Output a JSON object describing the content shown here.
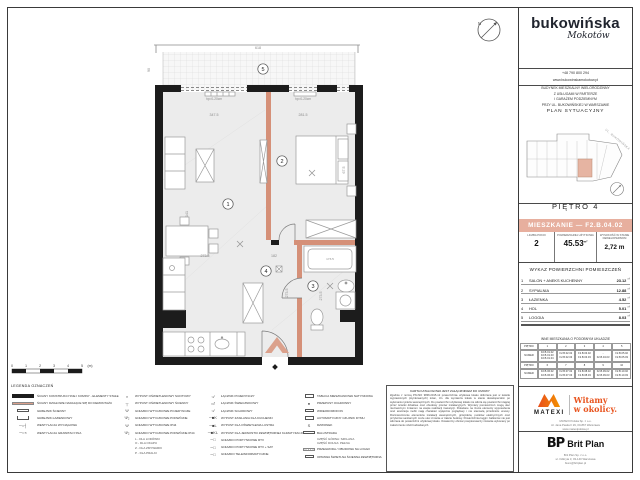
{
  "accent_salmon": "#e7af9e",
  "accent_orange": "#e8531d",
  "plan": {
    "room_numbers": [
      "1",
      "2",
      "3",
      "4",
      "5"
    ],
    "window_label_left": "hp=0-20cm",
    "window_label_right": "hp=0-20cm",
    "compass": "N",
    "dims": {
      "balcony": "618",
      "loggia_depth": "90",
      "salon_window": "347.5",
      "bedroom_window": "281.5",
      "salon_left": "141",
      "kitchen": "273.5",
      "hol": "182",
      "bathtub": "173.5",
      "bed": "67.5",
      "hol_v": "273.5",
      "bath_v": "273.5"
    },
    "scale_ticks": [
      "0",
      "1",
      "2",
      "3",
      "4",
      "5"
    ],
    "scale_unit": "(m)"
  },
  "sidebar": {
    "brand": {
      "name": "bukowińska",
      "script": "Mokotów"
    },
    "phone": "+48 790 800 294",
    "website": "www.bukowinskamokotow.pl",
    "description_lines": [
      "BUDYNEK MIESZKALNY WIELORODZINNY",
      "Z USŁUGAMI W PARTERZE",
      "I GARAŻEM PODZIEMNYM",
      "PRZY UL. BUKOWIŃSKIEJ W WARSZAWIE"
    ],
    "site_plan_title": "PLAN SYTUACYJNY",
    "street_label": "UL. BUKOWIŃSKA",
    "floor_label": "PIĘTRO 4",
    "apartment_label": "MIESZKANIE — F2.B.04.02",
    "stats": {
      "rooms": {
        "label": "LICZBA POKOI",
        "value": "2"
      },
      "area": {
        "label": "POWIERZCHNIA UŻYTKOWA",
        "value": "45.53",
        "unit": "m²"
      },
      "height": {
        "label": "WYSOKOŚĆ W STANIE DEWELOPERSKIM",
        "value": "2,72 m"
      }
    },
    "rooms_table": {
      "title": "WYKAZ POWIERZCHNI POMIESZCZEŃ",
      "unit": "m²",
      "rows": [
        {
          "no": "1",
          "name": "SALON + ANEKS KUCHENNY",
          "area": "23.12"
        },
        {
          "no": "2",
          "name": "SYPIALNIA",
          "area": "12.88"
        },
        {
          "no": "3",
          "name": "ŁAZIENKA",
          "area": "4.52"
        },
        {
          "no": "4",
          "name": "HOL",
          "area": "5.01"
        },
        {
          "no": "5",
          "name": "LOGGIA",
          "area": "8.03"
        }
      ]
    },
    "similar": {
      "title": "INNE MIESZKANIA O PODOBNYM UKŁADZIE",
      "row_label_floor": "PIĘTRO",
      "row_label_number": "NUMER",
      "group1": {
        "floors": [
          "1",
          "2",
          "3",
          "4",
          "5"
        ],
        "numbers": [
          "F2.B.01.02\nF2.B.01.03\nF2.B.01.04",
          "F2.B.02.02\nF2.B.02.03",
          "F2.B.03.02\nF2.B.03.03",
          "-\nF2.B.04.03",
          "F2.B.05.02\nF2.B.05.03"
        ]
      },
      "group2": {
        "floors": [
          "6",
          "7",
          "8",
          "9",
          "10"
        ],
        "numbers": [
          "F2.B.06.02\nF2.B.06.03",
          "F2.B.07.02\nF2.B.07.03",
          "F2.B.08.02\nF2.B.08.03",
          "F2.B.09.02\nF2.B.09.03",
          "F2.B.10.02\nF2.B.10.03"
        ]
      }
    },
    "matexi": {
      "name": "MATEXI",
      "tagline_line1": "Witamy",
      "tagline_line2": "w okolicy.",
      "address_lines": [
        "MATEXI Polska Sp. z o.o.",
        "Al. Jana Pawła II 29, 00-867 Warszawa",
        "www.matexipolska.pl"
      ]
    },
    "britplan": {
      "monogram": "BP",
      "name": "Brit Plan",
      "address_lines": [
        "Brit Plan Sp. z o.o.",
        "ul. Odkryta 3, 03-140 Warszawa",
        "biuro@britplan.pl"
      ]
    }
  },
  "legend": {
    "title": "LEGENDA OZNACZEŃ",
    "col_a": [
      {
        "label": "ŚCIANY KONSTRUKCYJNE I KOMINY - ELEMENTY STAŁE"
      },
      {
        "label": "ŚCIANY DZIAŁOWE NADAJĄCE SIĘ DO DEMONTAŻU"
      },
      {
        "label": "GRZEJNIK ŚCIENNY"
      },
      {
        "label": "GRZEJNIK ŁAZIENKOWY"
      },
      {
        "label": "WENTYLACJA WYCIĄGOWA"
      },
      {
        "label": "WENTYLACJA GRAWITACYJNA"
      }
    ],
    "col_b": [
      "WYPUST OŚWIETLENIOWY SUFITOWY",
      "WYPUST OŚWIETLENIOWY ŚCIENNY",
      "GNIAZDO WTYCZKOWE POJEDYNCZE",
      "GNIAZDO WTYCZKOWE PODWÓJNE",
      "GNIAZDO WTYCZKOWE IP44",
      "GNIAZDO WTYCZKOWE PODWÓJNE IP44"
    ],
    "col_b_sub": [
      "L - DLA LODÓWKI",
      "O - DLA OKAPU",
      "Z - DLA ZMYWARKI",
      "P - DLA PRALKI"
    ],
    "col_c": [
      "ŁĄCZNIK POJEDYNCZY",
      "ŁĄCZNIK ŚWIECZNIKOWY",
      "ŁĄCZNIK SCHODOWY",
      "WYPUST ZASILANIA DLA KUCHENKI",
      "WYPUST DLA OŚWIETLENIA LUSTRA",
      "WYPUST DLA JEDNOSTKI ZEWNĘTRZNEJ KLIMATYZACJI",
      "GNIAZDO PODTYNKOWE RTV",
      "GNIAZDO PODTYNKOWE RTV + SAT",
      "GNIAZDO TELEINFORMATYCZNE"
    ],
    "col_d": [
      "TABLICA MIESZKANIOWA NATYNKOWA",
      "PRZEPUST OCHRONNY",
      "WIDEODOMOFON",
      "AUTOMATYCZNY CZUJNIK DYMU",
      "DZWONEK",
      "BALUSTRADA",
      "PRZEGRODA / OBUDOWA NA LOGGII",
      "OPRAWA ŚWIETLNA ŚCIENNA ZEWNĘTRZNA"
    ],
    "col_d_sub": [
      "CZĘŚĆ GÓRNA: SZKLANA",
      "CZĘŚĆ DOLNA: PEŁNA"
    ]
  },
  "disclaimer": {
    "title": "KARTA KATALOGOWA JEST ZAŁĄCZNIKIEM DO UMOWY",
    "body": "Zgodnie z normą PN-ISO 9836:2015-12 powierzchnia użytkowa lokalu obliczana jest w świetle wyprawionych (otynkowanych) ścian, tzn. dla wymiarów lokalu w stanie deweloperskim po wykonaniu tynków wewnętrznych. Do powierzchni użytkowej lokalu nie wlicza się powierzchni zajętej przez ścianki działowe oraz obudowy pionów instalacyjnych. Wymiary pomieszczeń mogą ulec nieznacznym zmianom na etapie realizacji inwestycji. Pokazane na rzucie elementy wyposażenia oraz aranżacja mebli mają charakter wyłącznie poglądowy i nie stanowią przedmiotu umowy. Rozmieszczenie elementów instalacji wewnętrznych, grzejników, punktów elektrycznych oraz przyborów sanitarnych może ulec zmianie w trakcie budowy. Powierzchnia loggii i balkonów nie jest wliczana do powierzchni użytkowej lokalu. Ostateczny obmiar powykonawczy zostanie wykonany po zakończeniu robót budowlanych."
  }
}
